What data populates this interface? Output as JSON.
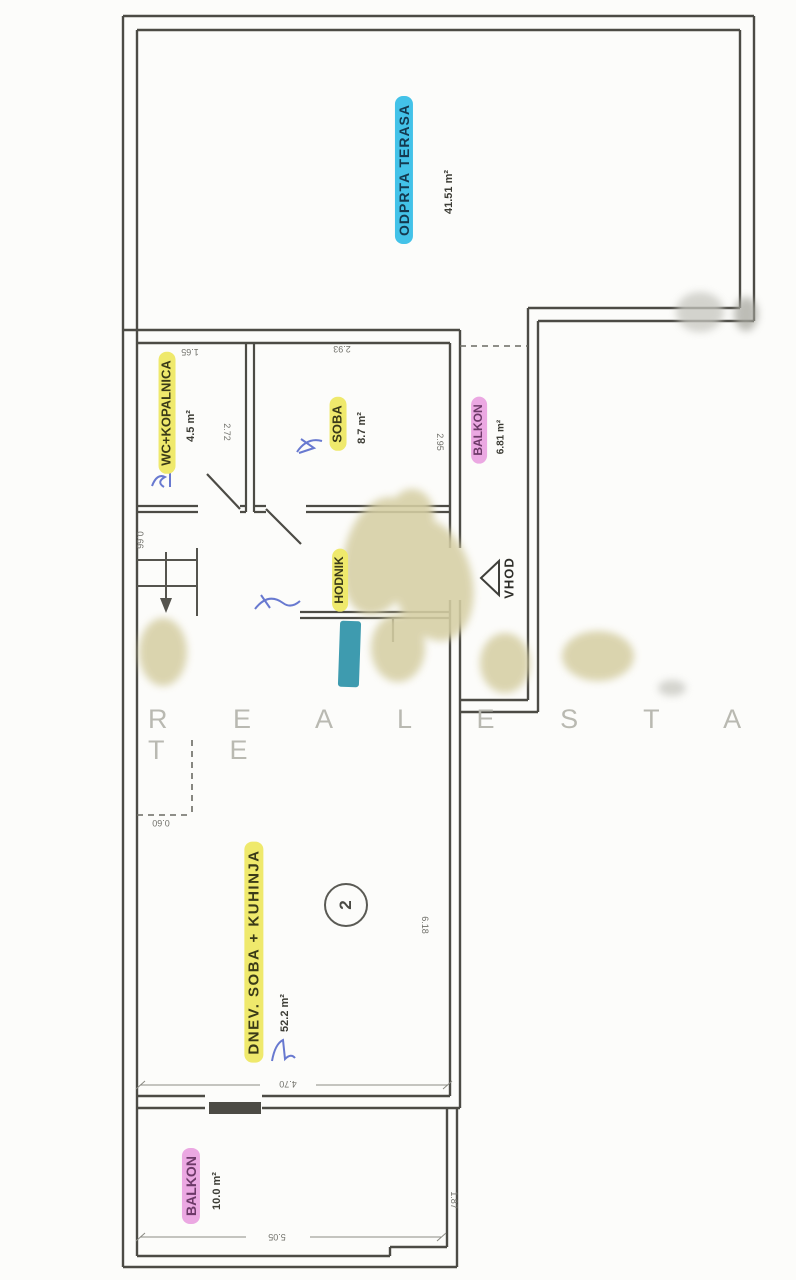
{
  "watermark": {
    "text": "R E A L  E S T A T E"
  },
  "rooms": {
    "terasa": {
      "name": "ODPRTA TERASA",
      "area": "41.51 m²"
    },
    "wc": {
      "name": "WC+KOPALNICA",
      "area": "4.5 m²"
    },
    "soba": {
      "name": "SOBA",
      "area": "8.7 m²"
    },
    "balkon_vhod": {
      "name": "BALKON",
      "area": "6.81 m²"
    },
    "hodnik": {
      "name": "HODNIK"
    },
    "dnevna": {
      "name": "DNEV. SOBA + KUHINJA",
      "area": "52.2 m²"
    },
    "balkon_spodnji": {
      "name": "BALKON",
      "area": "10.0 m²"
    }
  },
  "entrance": {
    "label": "VHOD"
  },
  "unit": {
    "number": "2"
  },
  "dimensions": {
    "wc_width": "1.65",
    "soba_width": "2.93",
    "wc_depth": "2.72",
    "soba_depth": "2.95",
    "stairs_width": "0.66",
    "niche_width": "0.60",
    "dnevna_depth": "6.18",
    "dnevna_width": "4.70",
    "balkon_depth": "1.87",
    "balkon_width": "5.05"
  },
  "colors": {
    "terrace_highlight": "#43c2e8",
    "room_highlight": "#efe96c",
    "balcony_highlight": "#eba8e2",
    "door_highlight": "#2e93a8",
    "wall_line": "#4c4b45",
    "watermark_text": "#b6b6ae",
    "pen_annotation": "#4e62c8"
  }
}
